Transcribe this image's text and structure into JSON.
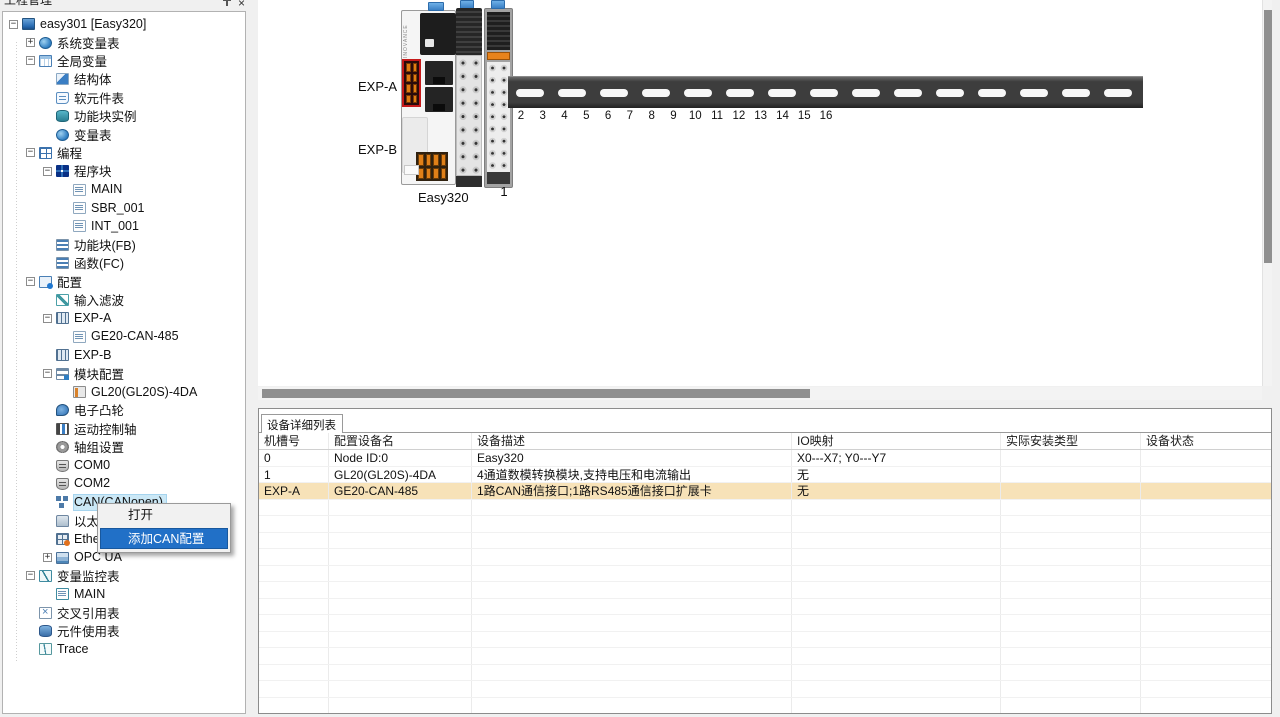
{
  "panel": {
    "title": "工程管理"
  },
  "tree": {
    "items": [
      {
        "id": "easy301",
        "label": "easy301 [Easy320]",
        "level": 0,
        "expander": "minus",
        "icon": "plc-monitor"
      },
      {
        "id": "system-vars",
        "label": "系统变量表",
        "level": 1,
        "expander": "plus",
        "icon": "sysvar-globe"
      },
      {
        "id": "global-vars",
        "label": "全局变量",
        "level": 1,
        "expander": "minus",
        "icon": "var-table"
      },
      {
        "id": "struct",
        "label": "结构体",
        "level": 2,
        "icon": "struct"
      },
      {
        "id": "soft-element-table",
        "label": "软元件表",
        "level": 2,
        "icon": "soft-element"
      },
      {
        "id": "fb-instance",
        "label": "功能块实例",
        "level": 2,
        "icon": "fb-instance"
      },
      {
        "id": "var-table",
        "label": "变量表",
        "level": 2,
        "icon": "vartab-globe"
      },
      {
        "id": "programming",
        "label": "编程",
        "level": 1,
        "expander": "minus",
        "icon": "programming"
      },
      {
        "id": "program-blocks",
        "label": "程序块",
        "level": 2,
        "expander": "minus",
        "icon": "program-blocks"
      },
      {
        "id": "main",
        "label": "MAIN",
        "level": 3,
        "icon": "pou-page"
      },
      {
        "id": "sbr-001",
        "label": "SBR_001",
        "level": 3,
        "icon": "pou-page"
      },
      {
        "id": "int-001",
        "label": "INT_001",
        "level": 3,
        "icon": "pou-page"
      },
      {
        "id": "fb",
        "label": "功能块(FB)",
        "level": 2,
        "icon": "fb-list"
      },
      {
        "id": "fc",
        "label": "函数(FC)",
        "level": 2,
        "icon": "fc-list"
      },
      {
        "id": "config",
        "label": "配置",
        "level": 1,
        "expander": "minus",
        "icon": "config-chip"
      },
      {
        "id": "input-filter",
        "label": "输入滤波",
        "level": 2,
        "icon": "filter-wave"
      },
      {
        "id": "exp-a",
        "label": "EXP-A",
        "level": 2,
        "expander": "minus",
        "icon": "exp-module"
      },
      {
        "id": "ge20-can-485",
        "label": "GE20-CAN-485",
        "level": 3,
        "icon": "card-page"
      },
      {
        "id": "exp-b",
        "label": "EXP-B",
        "level": 2,
        "icon": "exp-module"
      },
      {
        "id": "module-config",
        "label": "模块配置",
        "level": 2,
        "expander": "minus",
        "icon": "module-config"
      },
      {
        "id": "gl20-4da",
        "label": "GL20(GL20S)-4DA",
        "level": 3,
        "icon": "module-card"
      },
      {
        "id": "e-cam",
        "label": "电子凸轮",
        "level": 2,
        "icon": "cam"
      },
      {
        "id": "motion-axis",
        "label": "运动控制轴",
        "level": 2,
        "icon": "motion-axis"
      },
      {
        "id": "axis-group",
        "label": "轴组设置",
        "level": 2,
        "icon": "gear"
      },
      {
        "id": "com0",
        "label": "COM0",
        "level": 2,
        "icon": "com-port"
      },
      {
        "id": "com2",
        "label": "COM2",
        "level": 2,
        "icon": "com-port"
      },
      {
        "id": "can",
        "label": "CAN(CANopen)",
        "level": 2,
        "icon": "can-network",
        "selected": true
      },
      {
        "id": "ethernet",
        "label": "以太网",
        "level": 2,
        "icon": "ethernet"
      },
      {
        "id": "ethercat",
        "label": "EtherCAT",
        "level": 2,
        "icon": "ethercat"
      },
      {
        "id": "opc-ua",
        "label": "OPC UA",
        "level": 2,
        "expander": "plus",
        "icon": "opc"
      },
      {
        "id": "watch-table",
        "label": "变量监控表",
        "level": 1,
        "expander": "minus",
        "icon": "watch"
      },
      {
        "id": "watch-main",
        "label": "MAIN",
        "level": 2,
        "icon": "watch-page"
      },
      {
        "id": "cross-ref",
        "label": "交叉引用表",
        "level": 1,
        "icon": "cross-ref"
      },
      {
        "id": "element-usage",
        "label": "元件使用表",
        "level": 1,
        "icon": "usage"
      },
      {
        "id": "trace",
        "label": "Trace",
        "level": 1,
        "icon": "trace"
      }
    ]
  },
  "context_menu": {
    "items": [
      {
        "label": "打开"
      },
      {
        "label": "添加CAN配置",
        "highlighted": true
      }
    ]
  },
  "device_view": {
    "labels": {
      "exp_a": "EXP-A",
      "exp_b": "EXP-B",
      "cpu": "Easy320",
      "slot1": "1",
      "brand": "INOVANCE"
    },
    "rail_numbers": [
      "2",
      "3",
      "4",
      "5",
      "6",
      "7",
      "8",
      "9",
      "10",
      "11",
      "12",
      "13",
      "14",
      "15",
      "16"
    ]
  },
  "device_table": {
    "tab_label": "设备详细列表",
    "columns": [
      "机槽号",
      "配置设备名",
      "设备描述",
      "IO映射",
      "实际安装类型",
      "设备状态"
    ],
    "rows": [
      {
        "cells": [
          "0",
          "Node ID:0",
          "Easy320",
          "X0---X7; Y0---Y7",
          "",
          ""
        ],
        "highlighted": false
      },
      {
        "cells": [
          "1",
          "GL20(GL20S)-4DA",
          "4通道数模转换模块,支持电压和电流输出",
          "无",
          "",
          ""
        ],
        "highlighted": false
      },
      {
        "cells": [
          "EXP-A",
          "GE20-CAN-485",
          "1路CAN通信接口;1路RS485通信接口扩展卡",
          "无",
          "",
          ""
        ],
        "highlighted": true
      }
    ],
    "empty_row_count": 14
  },
  "colors": {
    "tree_selection": "#cbe8f6",
    "menu_highlight": "#2170c7",
    "row_highlight": "#f7e2b8",
    "clip_blue": "#3a7fc4",
    "rail_gray": "#3d3d3d",
    "exp_connector_red": "#c51a1a",
    "terminal_orange": "#e08018"
  }
}
